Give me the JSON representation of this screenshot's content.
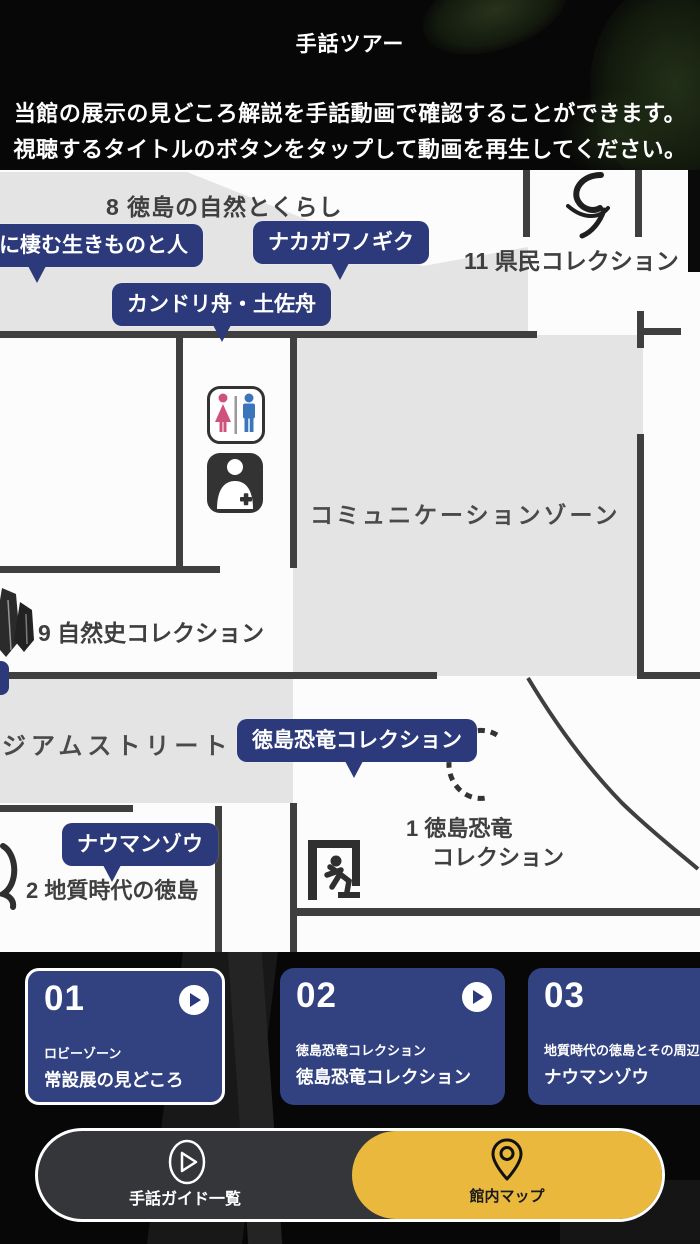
{
  "header": {
    "title": "手話ツアー",
    "description_line1": "当館の展示の見どころ解説を手話動画で確認することができます。",
    "description_line2": "視聴するタイトルのボタンをタップして動画を再生してください。"
  },
  "map": {
    "zones": {
      "zone8": "8 徳島の自然とくらし",
      "zone11": "11 県民コレクション",
      "communication": "コミュニケーションゾーン",
      "zone9": "9 自然史コレクション",
      "street": "ジアムストリート",
      "zone1_line1": "1 徳島恐竜",
      "zone1_line2": "コレクション",
      "zone2": "2 地質時代の徳島"
    },
    "pills": {
      "p1": "に棲む生きものと人",
      "p2": "ナカガワノギク",
      "p3": "カンドリ舟・土佐舟",
      "p4": "徳島恐竜コレクション",
      "p5": "ナウマンゾウ"
    },
    "icons": [
      "restroom-icon",
      "nursing-room-icon",
      "emergency-exit-icon",
      "mineral-crystal-icon",
      "ammonite-curl-icon",
      "dashed-spiral-path"
    ]
  },
  "cards": [
    {
      "number": "01",
      "subtitle": "ロビーゾーン",
      "title": "常設展の見どころ"
    },
    {
      "number": "02",
      "subtitle": "徳島恐竜コレクション",
      "title": "徳島恐竜コレクション"
    },
    {
      "number": "03",
      "subtitle": "地質時代の徳島とその周辺",
      "title": "ナウマンゾウ"
    }
  ],
  "nav": {
    "guide_label": "手話ガイド一覧",
    "map_label": "館内マップ"
  },
  "colors": {
    "pill_blue": "#2c3a7b",
    "card_blue": "#324180",
    "accent_yellow": "#e9b83d",
    "map_gray": "#e4e4e4",
    "wall_gray": "#3f3f3f"
  }
}
